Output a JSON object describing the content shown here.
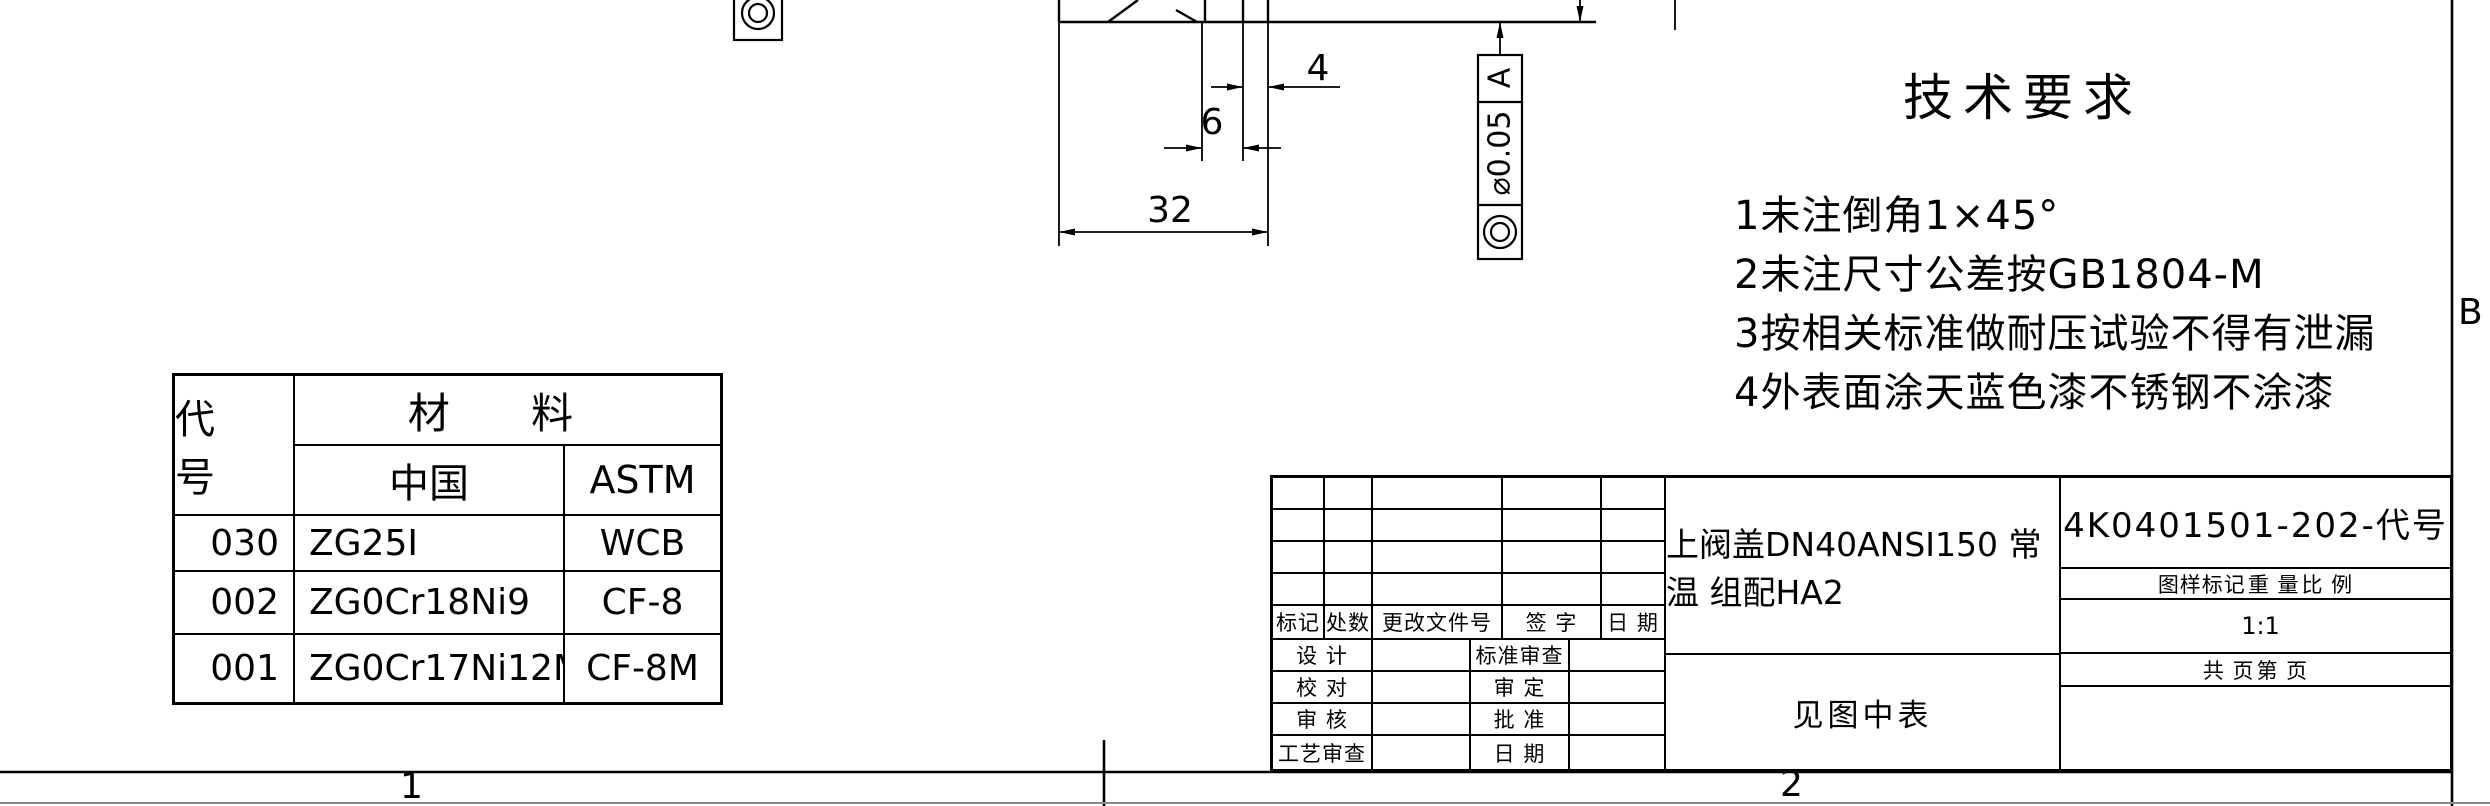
{
  "tech_requirements": {
    "title": "技术要求",
    "items": [
      "1未注倒角1×45°",
      "2未注尺寸公差按GB1804-M",
      "3按相关标准做耐压试验不得有泄漏",
      "4外表面涂天蓝色漆不锈钢不涂漆"
    ]
  },
  "materials_table": {
    "code_header": "代 号",
    "material_header": "材  料",
    "china_header": "中国",
    "astm_header": "ASTM",
    "rows": [
      {
        "code": "030",
        "china": "ZG25I",
        "astm": "WCB"
      },
      {
        "code": "002",
        "china": "ZG0Cr18Ni9",
        "astm": "CF-8"
      },
      {
        "code": "001",
        "china": "ZG0Cr17Ni12Mo2",
        "astm": "CF-8M"
      }
    ]
  },
  "dimensions": {
    "dim_4": "4",
    "dim_6": "6",
    "dim_32": "32"
  },
  "feature_control_frame": {
    "symbol": "concentricity",
    "tolerance": "⌀0.05",
    "datum": "A"
  },
  "zones": {
    "row_letter": "B",
    "col_1": "1",
    "col_2": "2"
  },
  "title_block": {
    "rev_headers": {
      "mark": "标记",
      "count": "处数",
      "change_doc_no": "更改文件号",
      "signature": "签 字",
      "date": "日 期"
    },
    "sig_labels": {
      "design": "设 计",
      "standard_review": "标准审查",
      "proofread": "校 对",
      "examine_approve": "审 定",
      "review": "审 核",
      "approve": "批 准",
      "process_review": "工艺审查",
      "date": "日 期"
    },
    "part_name": "上阀盖DN40ANSI150 常温 组配HA2",
    "material_ref": "见图中表",
    "drawing_number": "4K0401501-202-代号",
    "stamp_header": "图样标记",
    "weight_header": "重 量",
    "scale_header": "比 例",
    "scale_value": "1:1",
    "pages_total": "共    页",
    "page_no": "第    页"
  }
}
